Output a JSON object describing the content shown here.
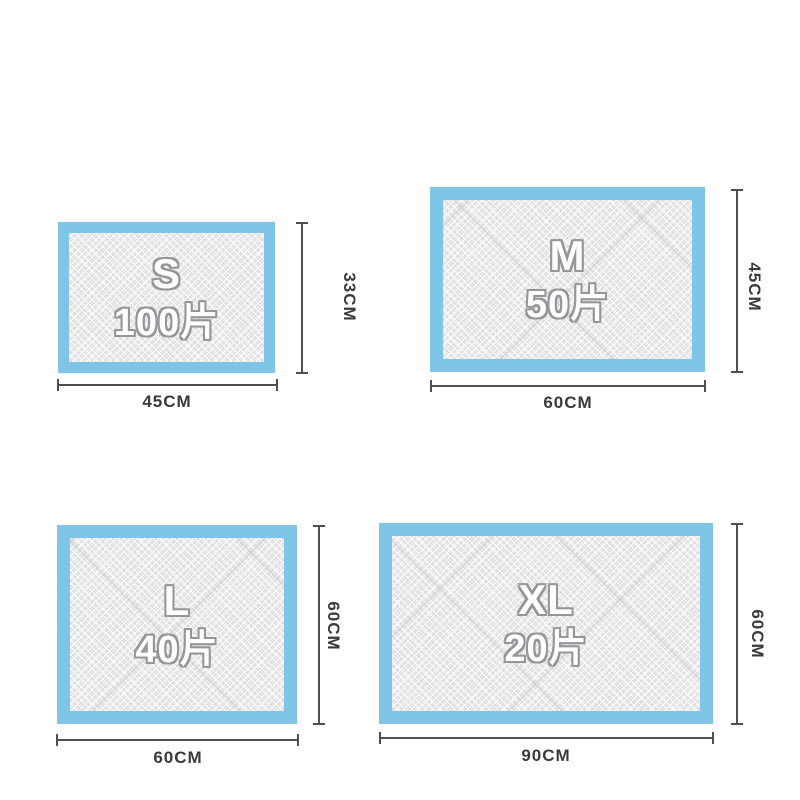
{
  "page": {
    "description": "Pet pee pad size comparison chart",
    "background": "#ffffff"
  },
  "colors": {
    "page_bg": "#ffffff",
    "pad_border": "#7ec5e7",
    "pad_fill": "#ebebed",
    "dim_line": "#4f4f4f",
    "dim_text": "#3a3a3a",
    "size_text_fill": "#ffffff",
    "size_text_outline": "#96969a"
  },
  "pads": [
    {
      "id": "s",
      "size_label": "S",
      "count_label": "100片",
      "width_label": "45CM",
      "height_label": "33CM"
    },
    {
      "id": "m",
      "size_label": "M",
      "count_label": "50片",
      "width_label": "60CM",
      "height_label": "45CM"
    },
    {
      "id": "l",
      "size_label": "L",
      "count_label": "40片",
      "width_label": "60CM",
      "height_label": "60CM"
    },
    {
      "id": "xl",
      "size_label": "XL",
      "count_label": "20片",
      "width_label": "90CM",
      "height_label": "60CM"
    }
  ]
}
